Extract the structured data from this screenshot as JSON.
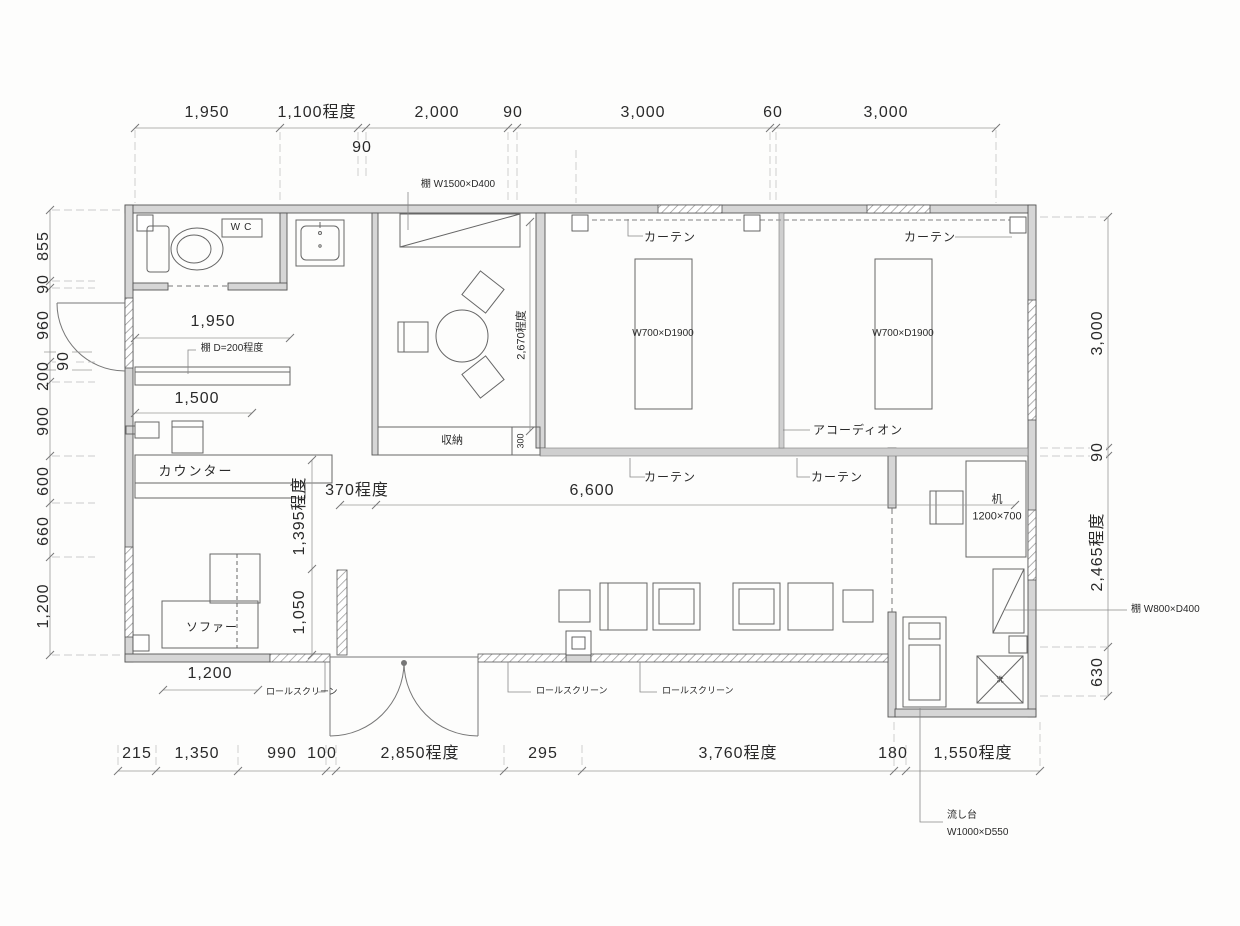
{
  "drawing": {
    "dims_top": [
      "1,950",
      "1,100程度",
      "2,000",
      "90",
      "3,000",
      "60",
      "3,000"
    ],
    "dim_top_sub": "90",
    "dims_left": [
      "855",
      "90",
      "960",
      "90",
      "200",
      "900",
      "600",
      "660",
      "1,200"
    ],
    "dims_right": [
      "3,000",
      "90",
      "2,465程度",
      "630"
    ],
    "dims_bottom": [
      "215",
      "1,350",
      "990",
      "100",
      "2,850程度",
      "295",
      "3,760程度",
      "180",
      "1,550程度"
    ],
    "dims_inner": {
      "shelf_width": "1,950",
      "counter_width": "1,500",
      "hall_offset": "370程度",
      "hall_width": "6,600",
      "hall_depth": "1,395程度",
      "entry_depth": "1,050",
      "room_depth": "2,670程度",
      "storage_depth": "300",
      "sofa_width": "1,200"
    },
    "rooms": {
      "wc": "WC",
      "storage": "収納",
      "counter": "カウンター",
      "sofa": "ソファー"
    },
    "fixtures": {
      "shelf_top": "棚 W1500×D400",
      "shelf_wall": "棚 D=200程度",
      "shelf_right": "棚 W800×D400",
      "curtain": "カーテン",
      "accordion": "アコーディオン",
      "futon": "W700×D1900",
      "desk_name": "机",
      "desk_size": "1200×700",
      "sink_name": "流し台",
      "sink_size": "W1000×D550",
      "roll_screen": "ロールスクリーン",
      "washer": "洗"
    }
  }
}
